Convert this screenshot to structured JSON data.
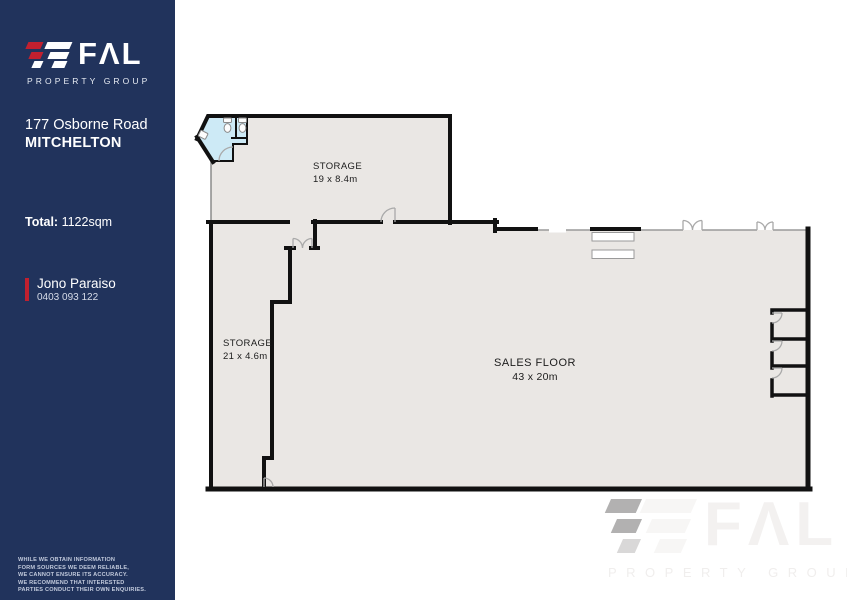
{
  "colors": {
    "sidebar_bg": "#21335c",
    "accent_red": "#c1202f",
    "floor_fill": "#eae7e4",
    "wet_area_fill": "#cdeaf6",
    "wall": "#111111",
    "window_line": "#9a9a9a"
  },
  "sidebar": {
    "logo": {
      "brand": "FAL",
      "brand_display": "FΛL",
      "tagline": "PROPERTY GROUP"
    },
    "address_line1": "177 Osborne Road",
    "address_line2": "MITCHELTON",
    "total_label": "Total:",
    "total_value": "1122sqm",
    "agent": {
      "name": "Jono Paraiso",
      "phone": "0403 093 122"
    },
    "disclaimer_lines": [
      "WHILE WE OBTAIN INFORMATION",
      "FORM SOURCES WE DEEM RELIABLE,",
      "WE CANNOT ENSURE ITS ACCURACY.",
      "WE RECOMMEND THAT INTERESTED",
      "PARTIES CONDUCT THEIR OWN ENQUIRIES."
    ]
  },
  "floorplan": {
    "rooms": [
      {
        "name": "STORAGE",
        "dimensions": "19 x 8.4m"
      },
      {
        "name": "STORAGE",
        "dimensions": "21 x 4.6m"
      },
      {
        "name": "SALES FLOOR",
        "dimensions": "43 x 20m"
      }
    ]
  },
  "watermark": {
    "brand": "FAL",
    "brand_display": "FΛL",
    "tagline": "PROPERTY GROUP"
  }
}
